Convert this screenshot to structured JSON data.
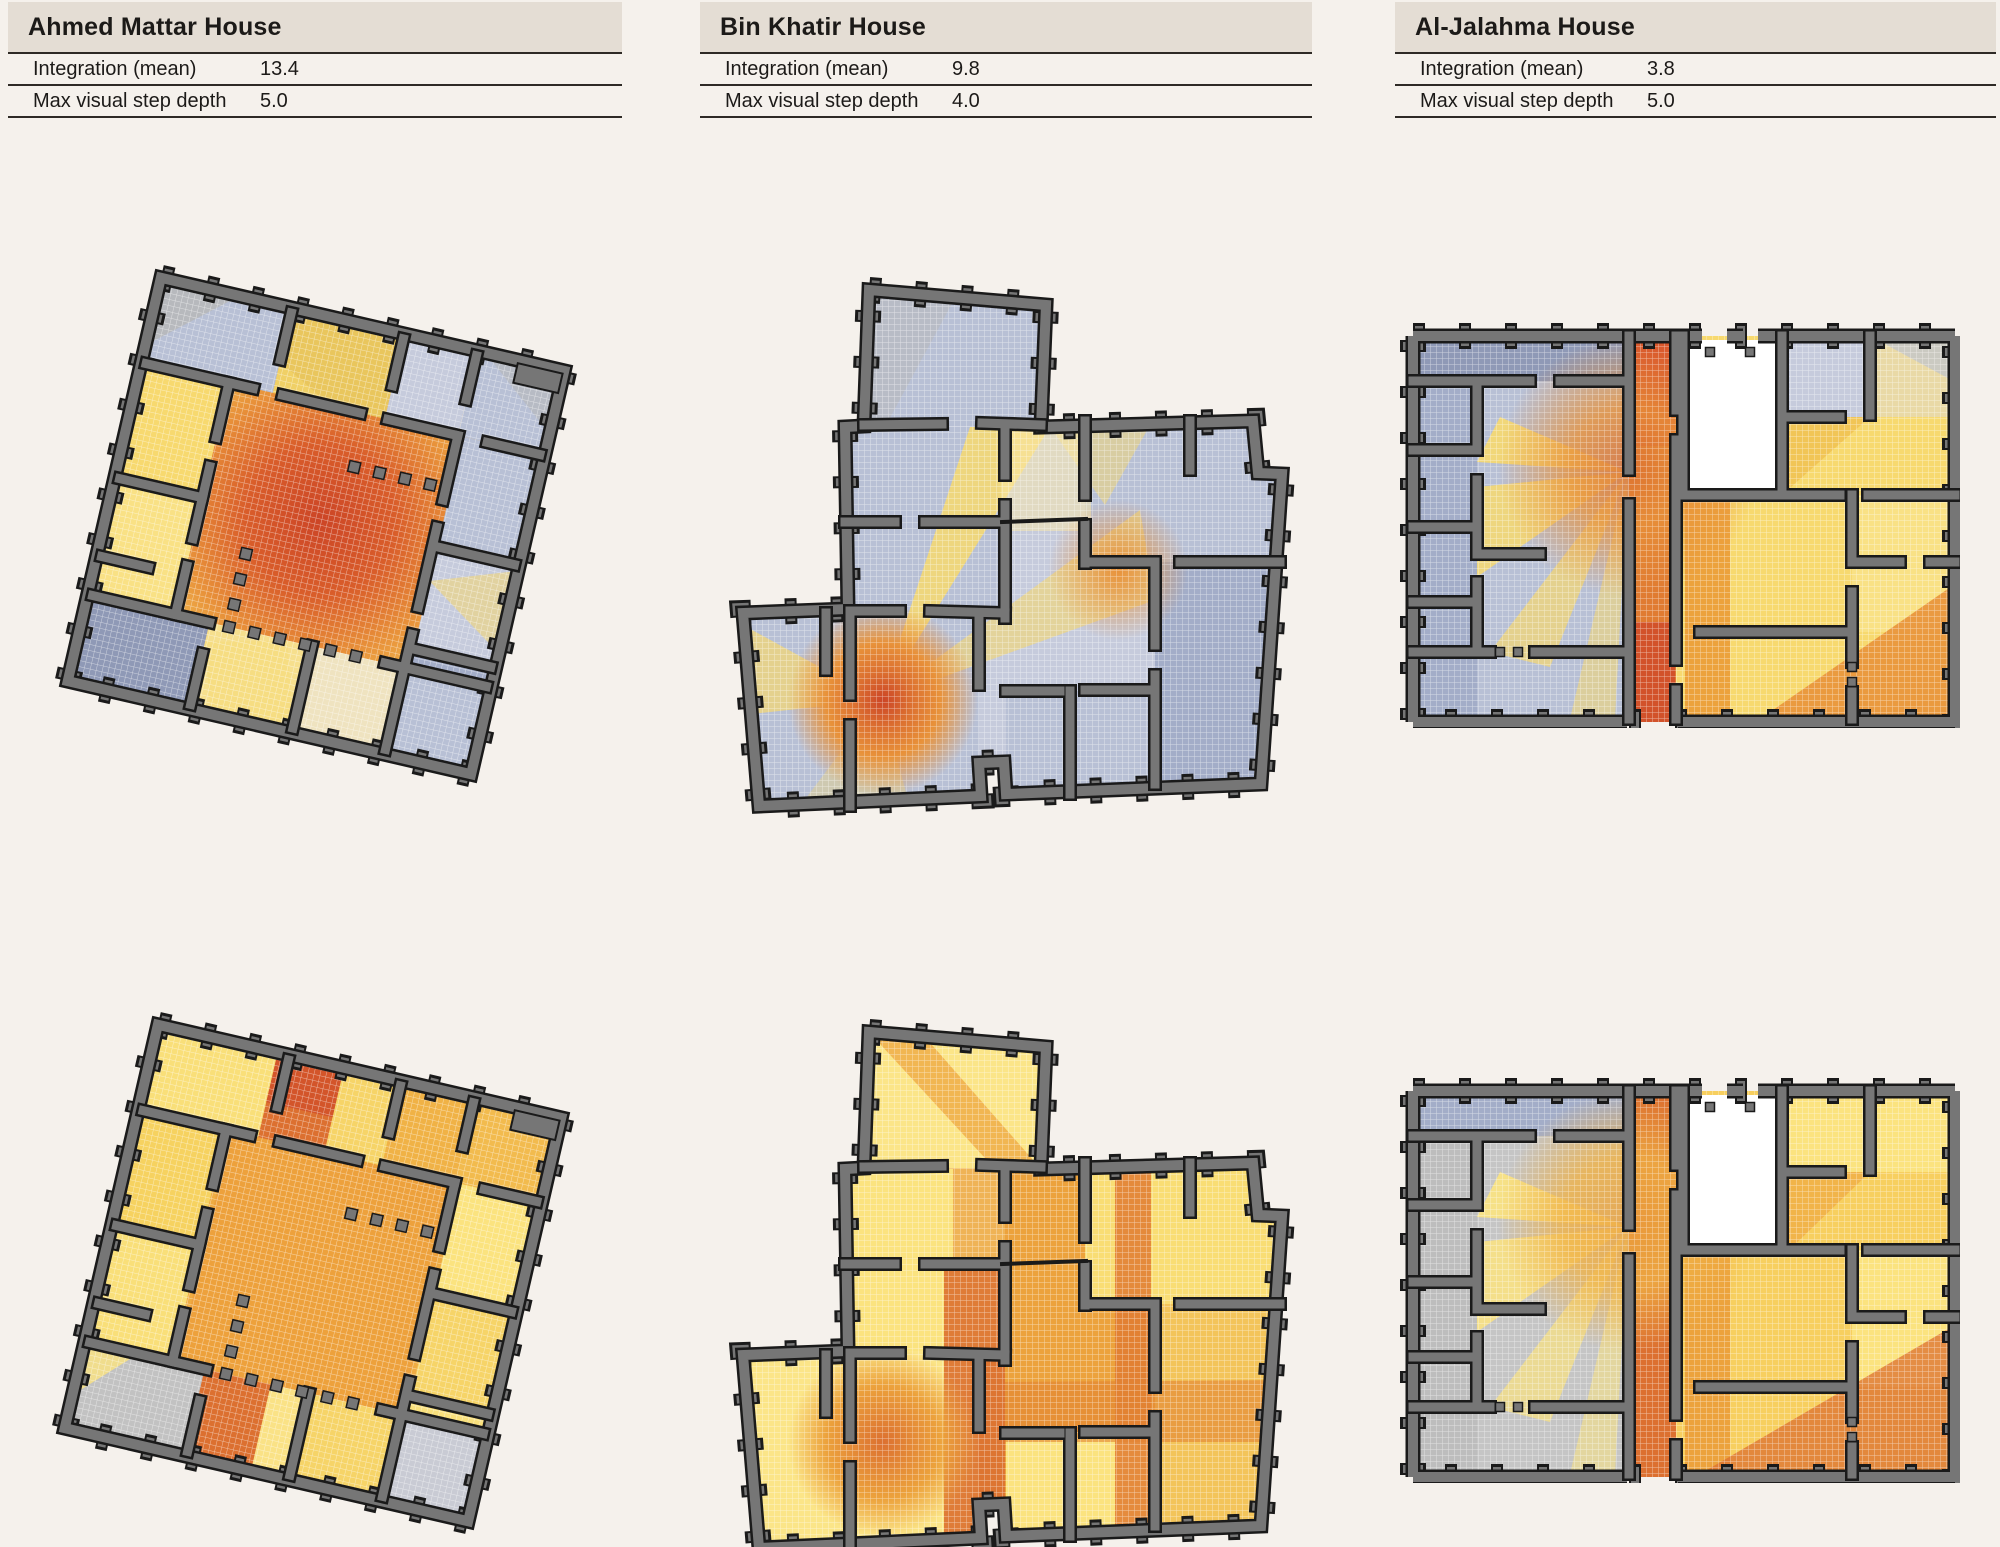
{
  "houses": [
    {
      "name": "Ahmed Mattar House",
      "metrics": [
        {
          "label": "Integration (mean)",
          "value": "13.4"
        },
        {
          "label": "Max visual step depth",
          "value": "5.0"
        }
      ]
    },
    {
      "name": "Bin Khatir House",
      "metrics": [
        {
          "label": "Integration (mean)",
          "value": "9.8"
        },
        {
          "label": "Max visual step depth",
          "value": "4.0"
        }
      ]
    },
    {
      "name": "Al-Jalahma House",
      "metrics": [
        {
          "label": "Integration (mean)",
          "value": "3.8"
        },
        {
          "label": "Max visual step depth",
          "value": "5.0"
        }
      ]
    }
  ],
  "colors": {
    "page_bg": "#f5f1ec",
    "header_bg": "#e4ddd4",
    "text": "#1c1a18",
    "rule": "#2e2a26",
    "wall": "#767676",
    "wall_outline": "#1a1a1a",
    "grid_line": "#ffffff",
    "heat": {
      "red": "#cc4526",
      "red2": "#d2522a",
      "deep_orange": "#dc7030",
      "orange": "#e8923a",
      "amber": "#eca23c",
      "amber2": "#f0b246",
      "gold": "#f6d468",
      "yellow": "#f7d96f",
      "yellow2": "#fbe37f",
      "pale_yellow": "#fbe9a8",
      "cream": "#efe3c0",
      "gray": "#c2c2c2",
      "gray2": "#b7b7b7",
      "slate_light": "#c6cbdc",
      "slate": "#b8c0d5",
      "slate_mid": "#a3adc8",
      "slate_dark": "#8f99b6"
    }
  }
}
